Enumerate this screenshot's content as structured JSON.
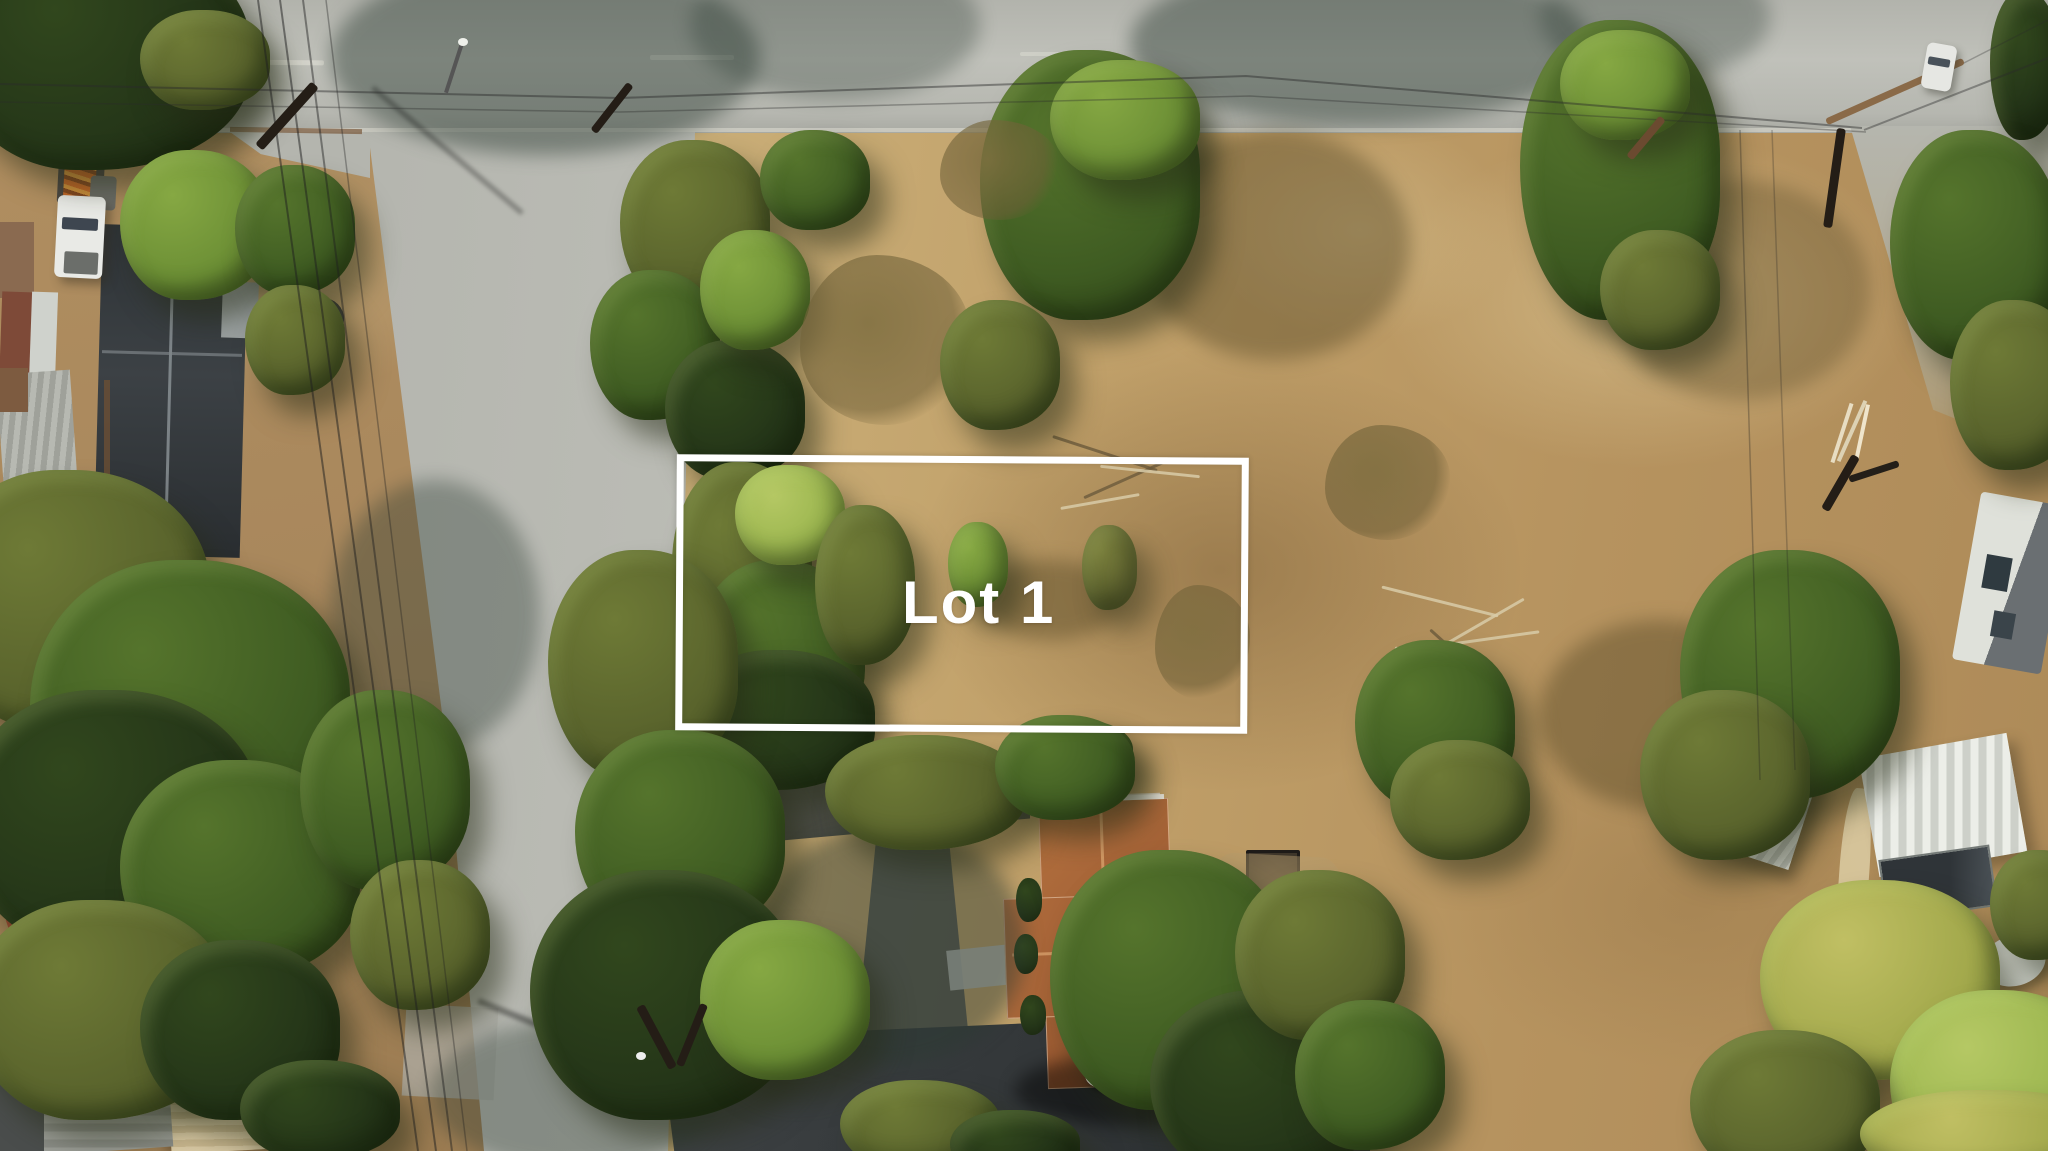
{
  "photo": {
    "kind": "aerial-drone-photo-of-vacant-residential-lot",
    "overlay": {
      "lot_label": "Lot 1",
      "boundary_color": "#ffffff"
    }
  },
  "palette": {
    "road_concrete": "#b9bab2",
    "road_tree_shadow": "#5f6f66",
    "dry_field_light": "#cdb37d",
    "dry_field_dark": "#ad8a58",
    "bare_dirt": "#a8875c",
    "dirt_patch": "#9b7a4e",
    "tree_dark": "#243518",
    "tree_mid": "#3f5c22",
    "tree_bright": "#6c8f35",
    "tree_yellow": "#a3a94c",
    "roof_dark_house": "#33383c",
    "roof_brown_house": "#a8653a",
    "asphalt_driveway": "#3b3f42",
    "shed_cream": "#d9c9a4",
    "metal_roof_white": "#eceee8",
    "truck_white": "#e9eae6"
  }
}
